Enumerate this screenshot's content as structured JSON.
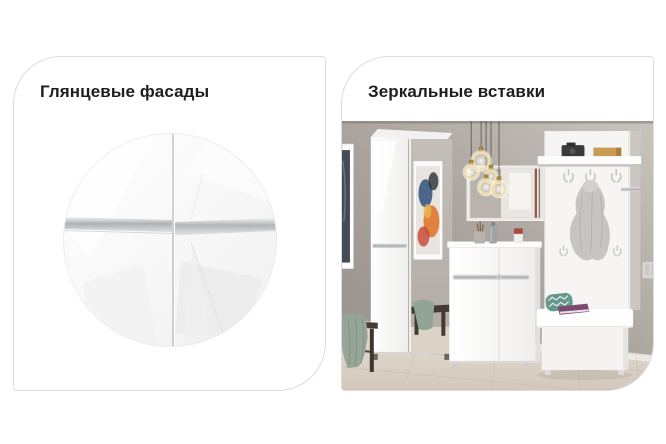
{
  "cards": [
    {
      "id": "glossy-facades",
      "title": "Глянцевые фасады",
      "image_desc": "circular close-up of glossy white cabinet doors with aluminium handle strip"
    },
    {
      "id": "mirror-inserts",
      "title": "Зеркальные вставки",
      "image_desc": "hallway set photo: wardrobe with mirror door, ring pendant lights, wall mirror, chest, coat-rack panel with shelf and hooks, white bench, dark bench with towel"
    }
  ],
  "colors": {
    "page_bg": "#ffffff",
    "card_border": "#dcdcdc",
    "title_text": "#1e1e1e",
    "photo_wall": "#a9a29c",
    "photo_floor": "#ddd4c9",
    "furniture_white": "#f7f6f5",
    "handle_silver": "#aeb2b5",
    "towel_sage": "#95a699",
    "pillow_teal": "#63988f",
    "book_purple": "#7c4a6e",
    "lamp_gold": "#b08a3e"
  }
}
